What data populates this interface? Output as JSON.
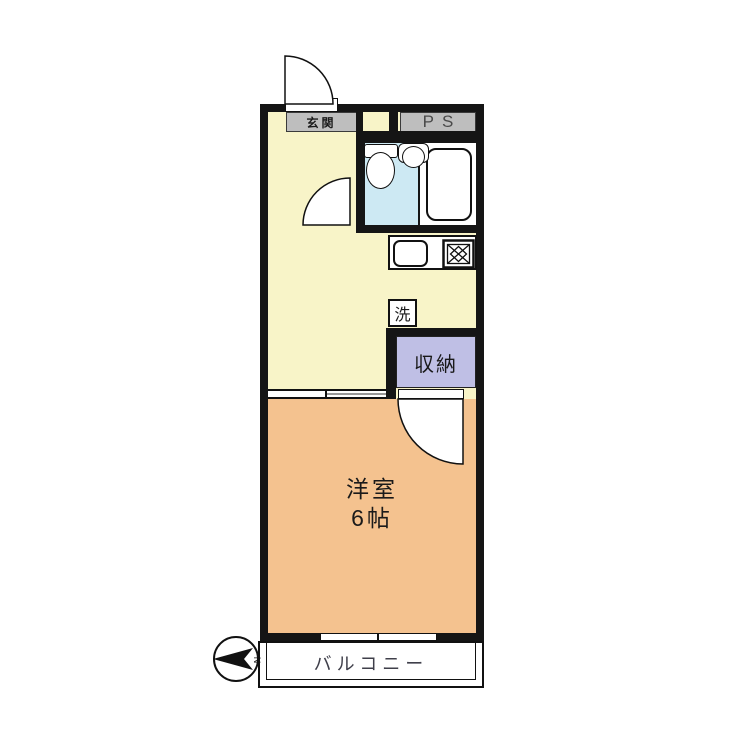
{
  "floorplan": {
    "entrance_label": "玄関",
    "pipe_space_label": "PS",
    "washer_label": "洗",
    "closet_label": "収納",
    "room_label_line1": "洋室",
    "room_label_line2": "6帖",
    "balcony_label": "バルコニー",
    "compass_north_label": "N"
  },
  "colors": {
    "wall": "#151515",
    "hallway_floor": "#F8F4C8",
    "main_room_floor": "#F4C28F",
    "bathroom_floor": "#CDE9F3",
    "closet_floor": "#BFBFE5",
    "label_background": "#BEBEBE",
    "fixture_white": "#FFFFFF",
    "balcony_text": "#3F3F4A"
  },
  "icons": {
    "entrance_door": "quarter-circle-door-swing",
    "bathroom_door": "quarter-circle-door-swing",
    "room_door": "quarter-circle-door-swing",
    "toilet": "tank-and-bowl",
    "wash_basin": "round-basin",
    "bathtub": "rounded-rectangle-tub",
    "kitchen_sink": "rounded-square-sink",
    "stove": "square-burner-cross",
    "sliding_window": "double-line-with-tick",
    "sliding_partition": "double-line-with-tick",
    "compass": "circle-with-north-arrow"
  }
}
